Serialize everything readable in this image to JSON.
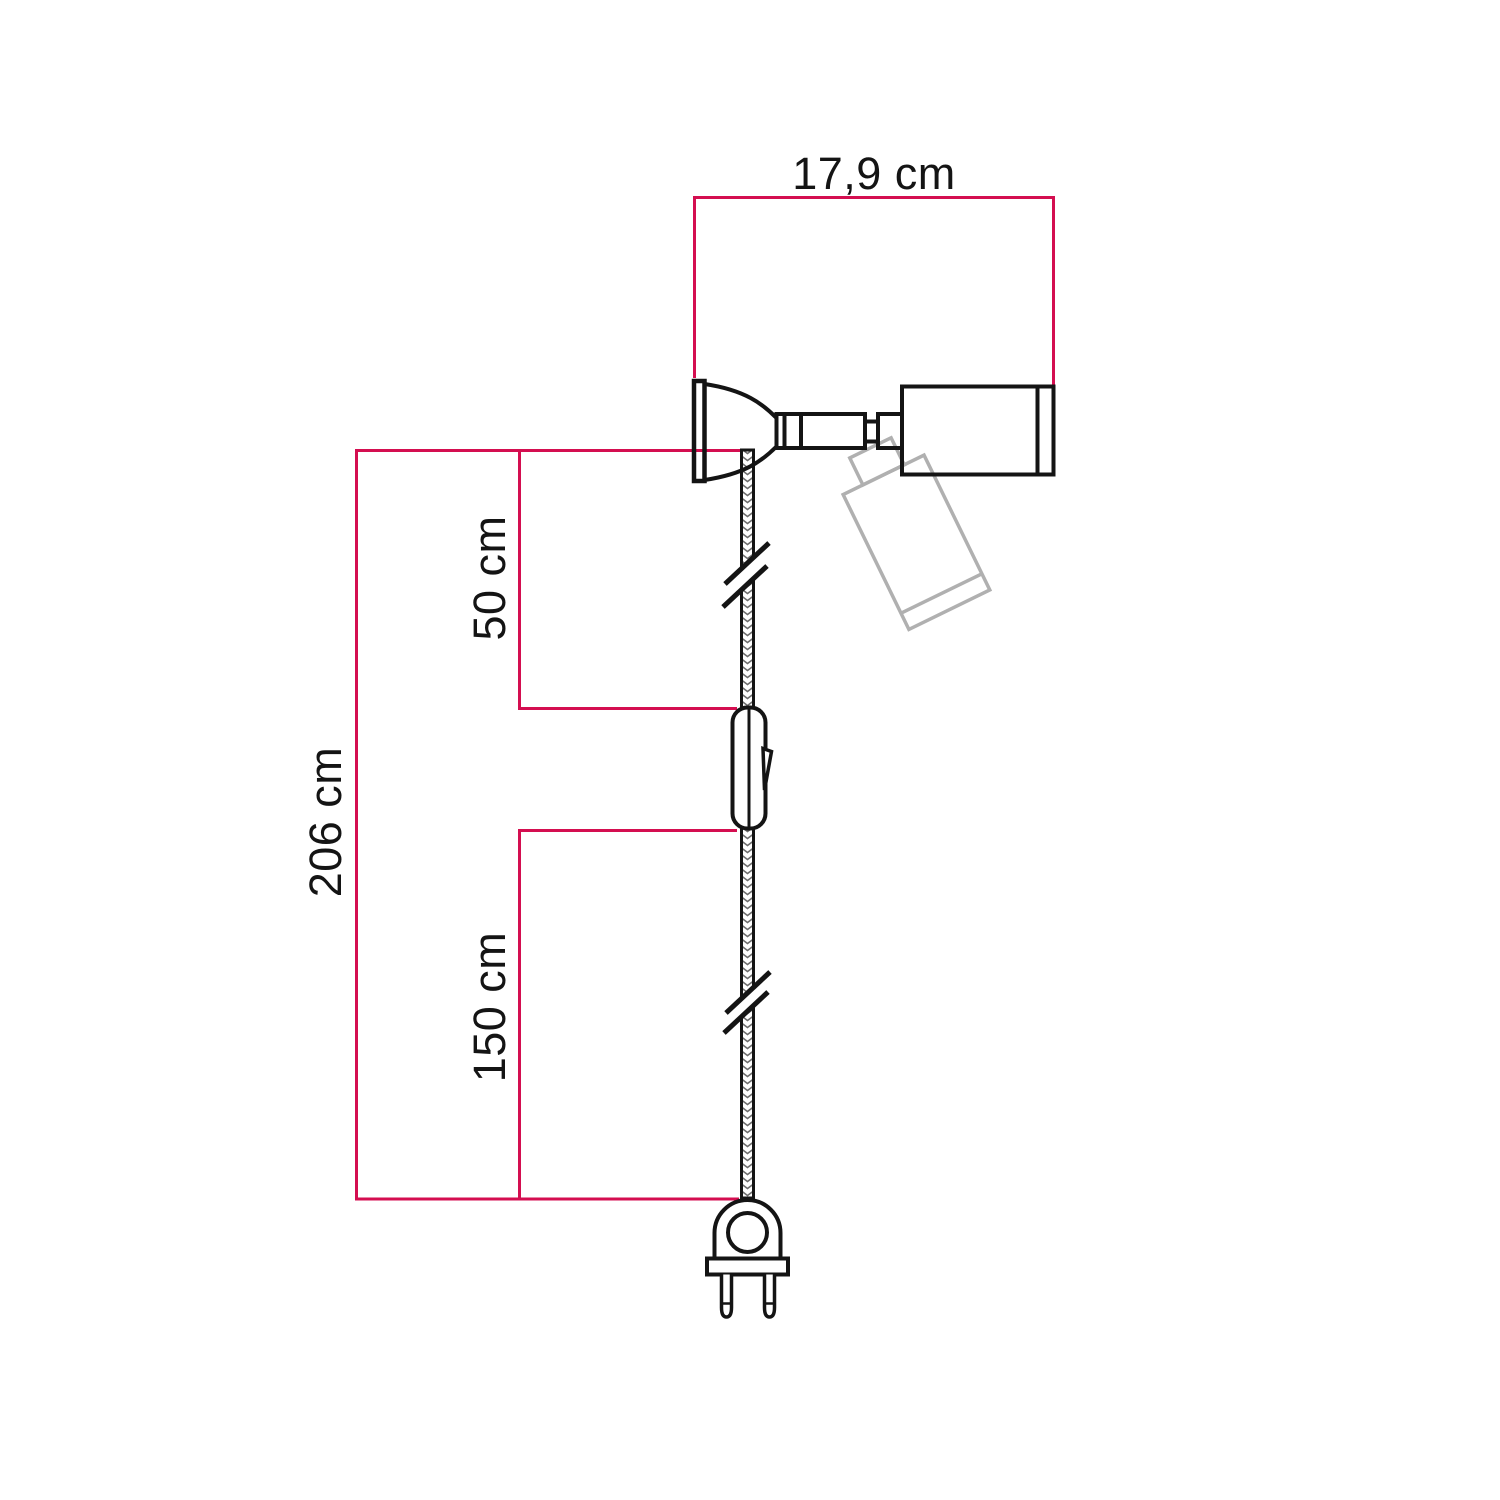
{
  "colors": {
    "accent": "#d40e50",
    "ink": "#141414",
    "ghost": "#b0b0b0",
    "braid": "#6e6e6e",
    "background": "#ffffff"
  },
  "dimensions": {
    "spot_width": {
      "label": "17,9 cm",
      "value_cm": 17.9
    },
    "total_length": {
      "label": "206 cm",
      "value_cm": 206
    },
    "upper_section": {
      "label": "50 cm",
      "value_cm": 50
    },
    "lower_section": {
      "label": "150 cm",
      "value_cm": 150
    }
  }
}
